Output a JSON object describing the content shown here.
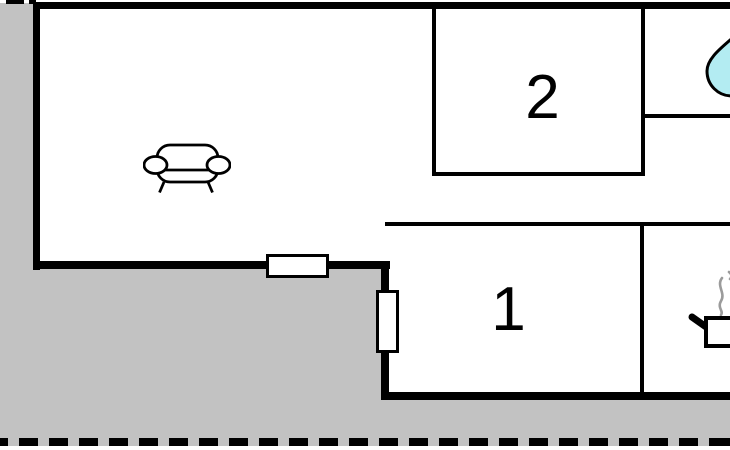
{
  "page": {
    "type": "floor-plan",
    "description": "Holiday home floor plan, ground level, partial crop"
  },
  "colors": {
    "background": "#c2c2c2",
    "wall": "#000000",
    "room_fill": "#ffffff",
    "water_drop": "#b3ecf2",
    "steam": "#9b9b9b",
    "label": "#000000"
  },
  "rooms": {
    "living_room": {
      "name": "living room",
      "furniture": "sofa"
    },
    "bedroom_2": {
      "label": "2"
    },
    "bedroom_1": {
      "label": "1"
    },
    "bathroom": {
      "icon": "water-drop"
    },
    "kitchen": {
      "icon": "cooking-pot"
    }
  },
  "icons": [
    {
      "name": "sofa-icon",
      "meaning": "sofa / living room"
    },
    {
      "name": "water-drop-icon",
      "meaning": "bathroom / water"
    },
    {
      "name": "cooking-pot-icon",
      "meaning": "kitchen / cooking"
    }
  ],
  "boundary": {
    "style": "dashed",
    "meaning": "property boundary"
  }
}
